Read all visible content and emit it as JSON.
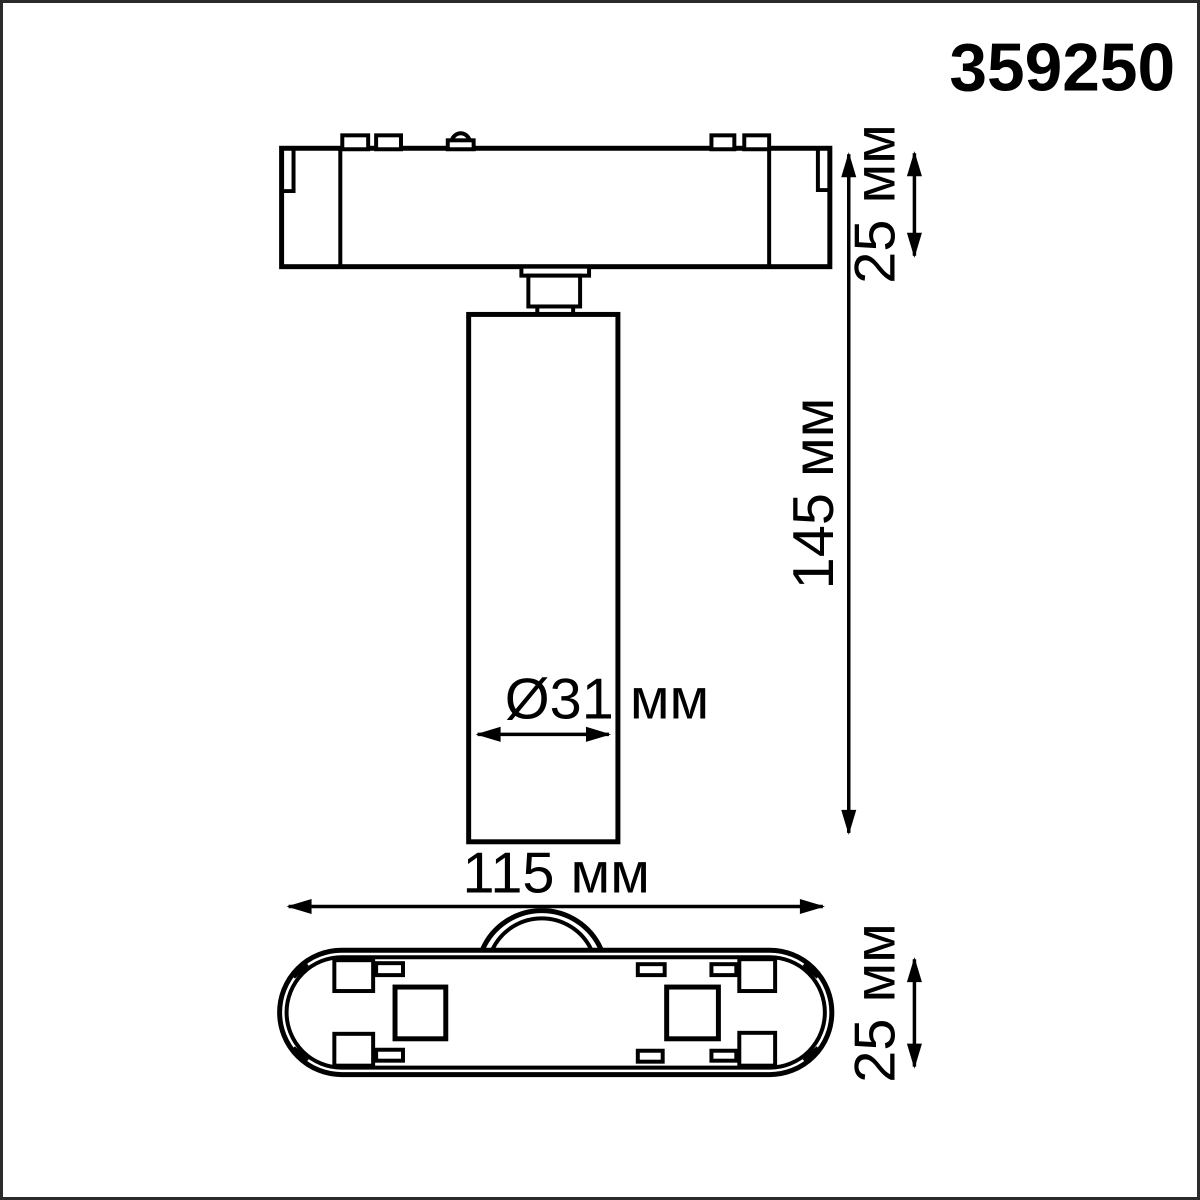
{
  "product_code": "359250",
  "dimensions": {
    "adapter_height": "25 мм",
    "body_height": "145 мм",
    "diameter": "Ø31 мм",
    "adapter_length": "115 мм",
    "adapter_depth": "25 мм"
  },
  "colors": {
    "line": "#000000",
    "background": "#ffffff",
    "frame_border": "#2b2b2b"
  }
}
